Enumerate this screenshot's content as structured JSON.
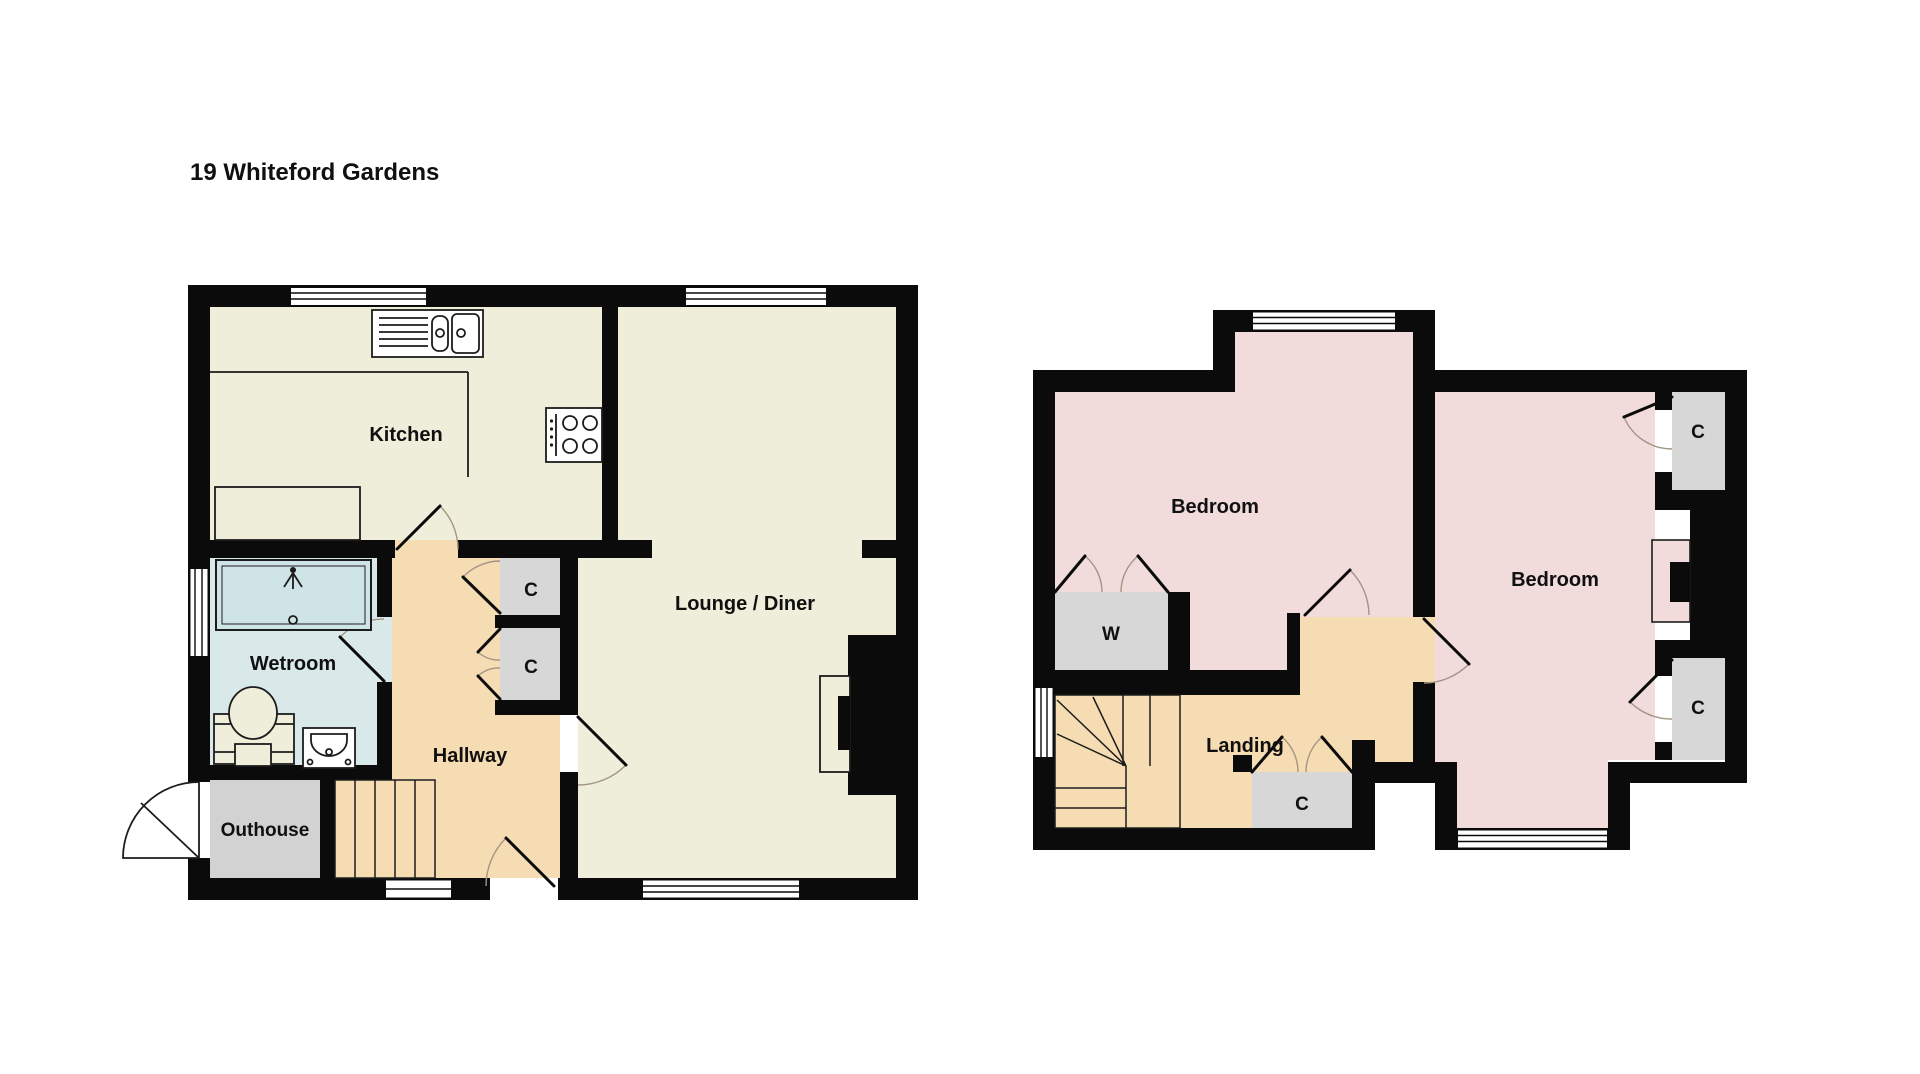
{
  "title": "19 Whiteford Gardens",
  "colors": {
    "wall_color": "#0b0b0b",
    "floor_cream": "#eeeedb",
    "floor_tan": "#f6dcb2",
    "floor_blue": "#d9e9ea",
    "floor_pink": "#f1dbdb",
    "closet_gray": "#d7d7d7",
    "outhouse_gray": "#d2d2d2",
    "arc_color": "#a29584"
  },
  "ground_floor": {
    "rooms": {
      "kitchen": "Kitchen",
      "lounge_diner": "Lounge / Diner",
      "wetroom": "Wetroom",
      "hallway": "Hallway",
      "outhouse": "Outhouse",
      "closet_upper": "C",
      "closet_lower": "C"
    }
  },
  "first_floor": {
    "rooms": {
      "bedroom_left": "Bedroom",
      "bedroom_right": "Bedroom",
      "landing": "Landing",
      "wardrobe": "W",
      "closet_landing": "C",
      "closet_top_right": "C",
      "closet_bottom_right": "C"
    }
  }
}
